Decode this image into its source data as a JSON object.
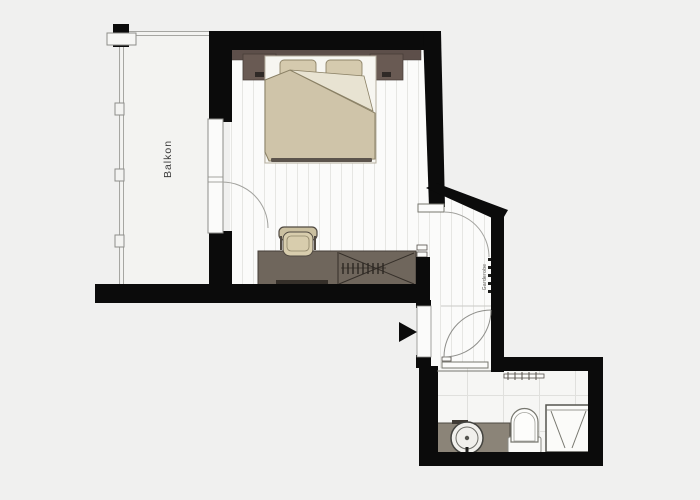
{
  "floorplan": {
    "labels": {
      "balcony": "Balkon",
      "coat_rack": "Garderobe"
    },
    "colors": {
      "background": "#f0f0ef",
      "wall": "#0b0b0b",
      "floor": "#fbfbfa",
      "floor_plank_line": "#e6e6e3",
      "bathroom_tile_line": "#e0e0dd",
      "balcony_floor": "#f3f3f1",
      "headboard_wood": "#5d4f4a",
      "nightstand_wood": "#695a53",
      "desk_wood": "#6f665c",
      "duvet_beige": "#cfc4a9",
      "pillow_beige": "#d5caae",
      "chair_beige": "#d8cdad",
      "vanity_counter": "#8b8478",
      "door_leaf": "#fbfbfa",
      "door_arc": "#a2a29e",
      "railing": "#a6a6a2"
    },
    "icons": {
      "entrance_arrow": "right-pointing-triangle-entrance-marker"
    }
  }
}
